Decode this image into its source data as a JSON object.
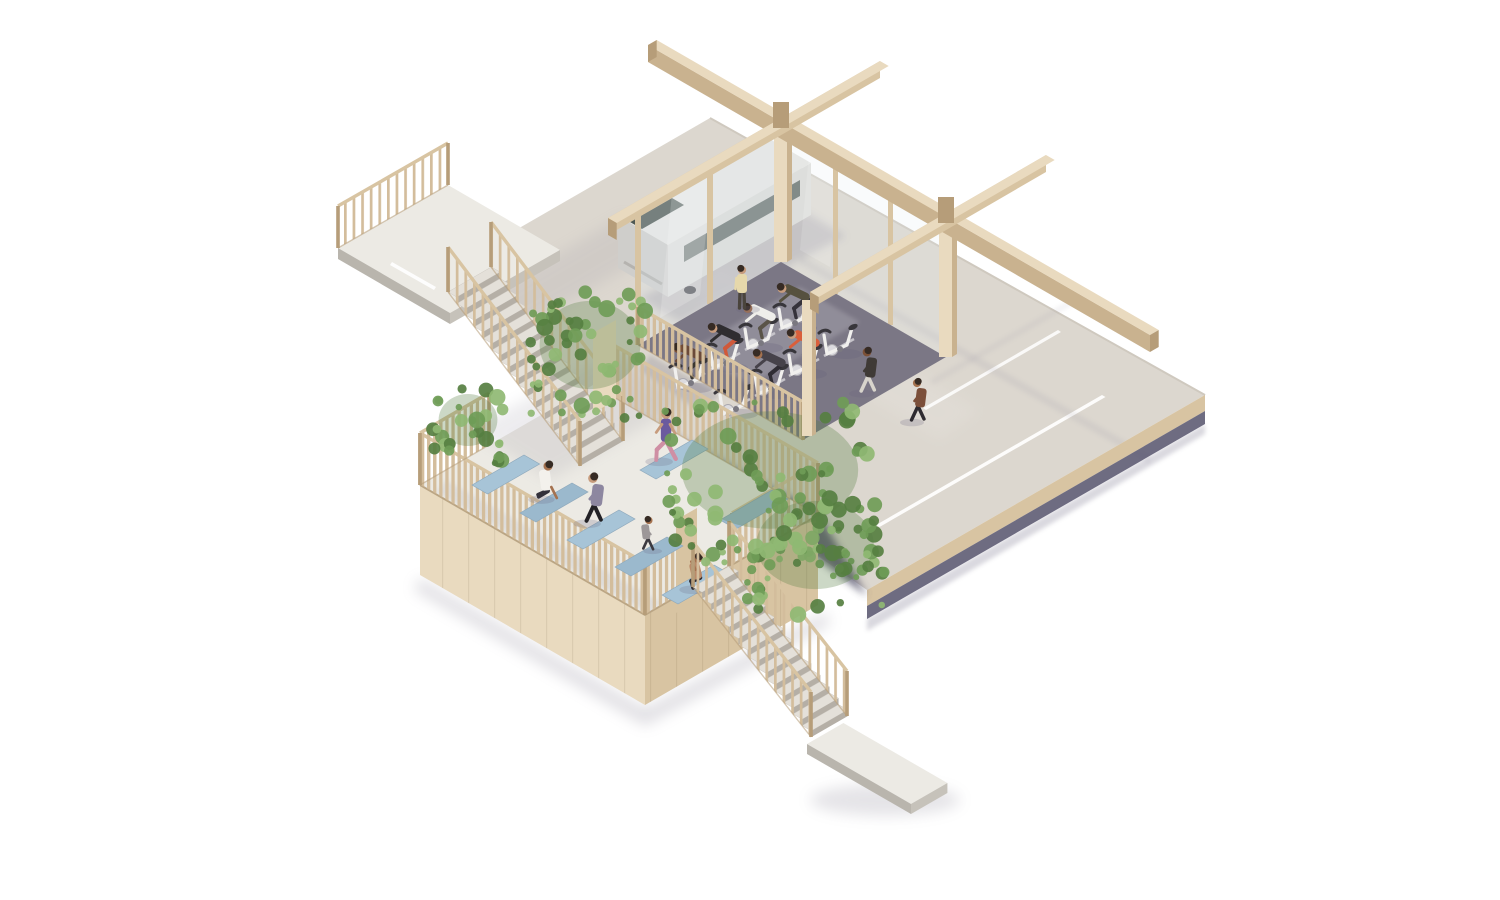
{
  "scene": {
    "description": "Isometric architectural rendering of a pale-timber parking structure reused as a fitness pavilion: glazed spin studio and parked white van on the upper parking deck, open-air yoga deck below left, two outdoor stairs with slatted timber railings and trailing vine planting, empty roadway slab to the right",
    "view": "axonometric on white background"
  },
  "upper_deck": {
    "label": "parking deck with spin studio",
    "vehicle": "white van",
    "bike_count": 8,
    "rider_count": 6,
    "standing_people": 1,
    "walking_people": 2,
    "lane_line_count": 2
  },
  "yoga_deck": {
    "label": "open-air yoga deck",
    "mat_count": 7,
    "people_count": 5
  },
  "stairs": {
    "upper_flight_steps": 15,
    "lower_flight_steps": 13
  },
  "planting": {
    "vine_clusters": 4
  },
  "colors": {
    "background": "#ffffff",
    "wood_light": "#e9dabf",
    "wood_mid": "#d8c4a2",
    "wood_dark": "#b69d79",
    "wood_side": "#c9b28f",
    "slat": "#d3bd9c",
    "concrete_light": "#eceae4",
    "concrete_road": "#dcd7cf",
    "concrete_stair": "#e4e0d9",
    "riser": "#b5afa6",
    "lane_line": "#ffffff",
    "under_shadow": "#55526b",
    "soft_shadow": "#8b8797",
    "studio_floor": "#7b7785",
    "glass": "#dfeaf0",
    "mat_blue": "#a7c4d7",
    "mat_blue_alt": "#9bb9cd",
    "vine_dark": "#567f41",
    "vine_mid": "#6f9c57",
    "vine_light": "#8fb873",
    "van_body": "#dcdbd7",
    "van_roof": "#e8e7e3",
    "van_shade": "#cfcecb",
    "van_window": "#404c46",
    "bike_frame": "#f1f0ee",
    "bike_metal": "#c6c4ca",
    "bike_dark": "#38363b",
    "skin_light": "#c79c7d",
    "skin_mid": "#a5724f",
    "skin_dark": "#7c5137",
    "hair_dark": "#362b24"
  },
  "people": {
    "riders": [
      {
        "top": "#56513f",
        "bottom": "#35323a",
        "skin": "#c79c7d"
      },
      {
        "top": "#efeeea",
        "bottom": "#5a5448",
        "skin": "#a5724f"
      },
      {
        "top": "#2f2d30",
        "bottom": "#d0593a",
        "skin": "#c79c7d"
      },
      {
        "top": "#6b4a3a",
        "bottom": "#3a3732",
        "skin": "#7c5137"
      },
      {
        "top": "#d95f3b",
        "bottom": "#3c393f",
        "skin": "#c79c7d"
      },
      {
        "top": "#46424a",
        "bottom": "#2f2c33",
        "skin": "#a5724f"
      }
    ],
    "standing": {
      "top": "#e6d8ab",
      "bottom": "#4a443c",
      "skin": "#c79c7d"
    },
    "walkers": [
      {
        "top": "#3f3a36",
        "bottom": "#d8d4cc",
        "skin": "#7c5137"
      },
      {
        "top": "#7b4f3a",
        "bottom": "#2e2b30",
        "skin": "#a5724f"
      }
    ],
    "yoga": [
      {
        "pose": "sit",
        "top": "#f3f1ec",
        "bottom": "#33313a",
        "skin": "#a5724f"
      },
      {
        "pose": "walk",
        "top": "#8d87a0",
        "bottom": "#232226",
        "skin": "#c79c7d"
      },
      {
        "pose": "kid",
        "top": "#9c9798",
        "bottom": "#3c3a40",
        "skin": "#a5724f"
      },
      {
        "pose": "lunge",
        "top": "#6b5a9e",
        "bottom": "#cf8fa4",
        "skin": "#c79c7d"
      },
      {
        "pose": "squat",
        "top": "#b98a69",
        "bottom": "#2e2c31",
        "skin": "#a5724f"
      }
    ]
  }
}
